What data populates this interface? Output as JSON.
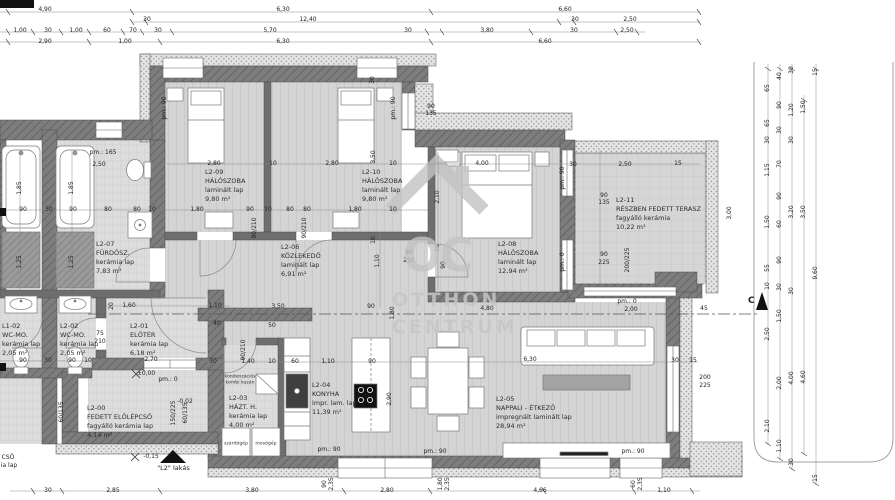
{
  "watermark": {
    "monogram": "OC",
    "line1": "OTTHON",
    "line2": "CENTRUM"
  },
  "unit_label": "\"L2\" lakás",
  "section_marker": "C",
  "colors": {
    "wall": "#7d7d7d",
    "insulation_dot": "#9f9f9f",
    "floor": "#d4d4d4",
    "watermark": "#c3c3c3",
    "fixture_dark": "#3f3f3f"
  },
  "rooms": [
    {
      "id": "L2-09",
      "name": "HÁLÓSZOBA",
      "floor": "laminált lap",
      "area": "9,80 m²"
    },
    {
      "id": "L2-10",
      "name": "HÁLÓSZOBA",
      "floor": "laminált lap",
      "area": "9,80 m²"
    },
    {
      "id": "L2-08",
      "name": "HÁLÓSZOBA",
      "floor": "laminált lap",
      "area": "12,94 m²"
    },
    {
      "id": "L2-11",
      "name": "RÉSZBEN FEDETT TERASZ",
      "floor": "fagyálló kerámia",
      "area": "10,22 m²"
    },
    {
      "id": "L2-06",
      "name": "KÖZLEKEDŐ",
      "floor": "laminált lap",
      "area": "6,91 m²"
    },
    {
      "id": "L2-07",
      "name": "FÜRDŐSZ.",
      "floor": "kerámia lap",
      "area": "7,83 m²"
    },
    {
      "id": "L1-02",
      "name": "WC-MO.",
      "floor": "kerámia lap",
      "area": "2,05 m²"
    },
    {
      "id": "L2-02",
      "name": "WC-MO.",
      "floor": "kerámia lap",
      "area": "2,05 m²"
    },
    {
      "id": "L2-01",
      "name": "ELŐTÉR",
      "floor": "kerámia lap",
      "area": "6,18 m²"
    },
    {
      "id": "L2-00",
      "name": "FEDETT ELŐLÉPCSŐ",
      "floor": "fagyálló kerámia lap",
      "area": "4,14 m²"
    },
    {
      "id": "L2-03",
      "name": "HÁZT. H.",
      "floor": "kerámia lap",
      "area": "4,00 m²"
    },
    {
      "id": "L2-04",
      "name": "KONYHA",
      "floor": "impr. lam. lap",
      "area": "11,39 m²"
    },
    {
      "id": "L2-05",
      "name": "NAPPALI - ÉTKEZŐ",
      "floor": "impregnált laminált lap",
      "area": "28,94 m²"
    }
  ],
  "fixtures": {
    "boiler_l1": "kondenzációs",
    "boiler_l2": "kombi kazán",
    "dryer": "szárítógép",
    "washer": "mosógép"
  },
  "dims": [
    {
      "t": "4,90",
      "x": 45,
      "y": 10
    },
    {
      "t": "6,30",
      "x": 283,
      "y": 10
    },
    {
      "t": "6,60",
      "x": 565,
      "y": 10
    },
    {
      "t": "30",
      "x": 147,
      "y": 20
    },
    {
      "t": "12,40",
      "x": 308,
      "y": 20
    },
    {
      "t": "30",
      "x": 575,
      "y": 20
    },
    {
      "t": "2,50",
      "x": 630,
      "y": 20
    },
    {
      "t": "1,00",
      "x": 20,
      "y": 31
    },
    {
      "t": "30",
      "x": 48,
      "y": 31
    },
    {
      "t": "1,00",
      "x": 76,
      "y": 31
    },
    {
      "t": "60",
      "x": 107,
      "y": 31
    },
    {
      "t": "70",
      "x": 133,
      "y": 31
    },
    {
      "t": "30",
      "x": 158,
      "y": 31
    },
    {
      "t": "5,70",
      "x": 270,
      "y": 31
    },
    {
      "t": "30",
      "x": 408,
      "y": 31
    },
    {
      "t": "3,80",
      "x": 487,
      "y": 31
    },
    {
      "t": "30",
      "x": 574,
      "y": 31
    },
    {
      "t": "2,50",
      "x": 627,
      "y": 31
    },
    {
      "t": "2,90",
      "x": 45,
      "y": 42
    },
    {
      "t": "1,00",
      "x": 125,
      "y": 42
    },
    {
      "t": "6,30",
      "x": 283,
      "y": 42
    },
    {
      "t": "6,60",
      "x": 545,
      "y": 42
    },
    {
      "t": "30",
      "x": 48,
      "y": 491
    },
    {
      "t": "2,85",
      "x": 113,
      "y": 491
    },
    {
      "t": "3,80",
      "x": 252,
      "y": 491
    },
    {
      "t": "2,80",
      "x": 387,
      "y": 491
    },
    {
      "t": "4,66",
      "x": 540,
      "y": 491
    },
    {
      "t": "1,10",
      "x": 664,
      "y": 491
    },
    {
      "t": "90",
      "x": 325,
      "y": 484,
      "r": 1
    },
    {
      "t": "2,35",
      "x": 332,
      "y": 484,
      "r": 1
    },
    {
      "t": "1,80",
      "x": 441,
      "y": 484,
      "r": 1
    },
    {
      "t": "2,35",
      "x": 448,
      "y": 484,
      "r": 1
    },
    {
      "t": "60",
      "x": 634,
      "y": 484,
      "r": 1
    },
    {
      "t": "2,35",
      "x": 641,
      "y": 484,
      "r": 1
    },
    {
      "t": "65",
      "x": 768,
      "y": 88,
      "r": 1
    },
    {
      "t": "65",
      "x": 768,
      "y": 123,
      "r": 1
    },
    {
      "t": "30",
      "x": 768,
      "y": 140,
      "r": 1
    },
    {
      "t": "1,15",
      "x": 768,
      "y": 170,
      "r": 1
    },
    {
      "t": "1,50",
      "x": 768,
      "y": 222,
      "r": 1
    },
    {
      "t": "55",
      "x": 768,
      "y": 268,
      "r": 1
    },
    {
      "t": "10",
      "x": 768,
      "y": 286,
      "r": 1
    },
    {
      "t": "2,50",
      "x": 768,
      "y": 334,
      "r": 1
    },
    {
      "t": "2,10",
      "x": 768,
      "y": 426,
      "r": 1
    },
    {
      "t": "40",
      "x": 780,
      "y": 76,
      "r": 1
    },
    {
      "t": "90",
      "x": 780,
      "y": 105,
      "r": 1
    },
    {
      "t": "30",
      "x": 780,
      "y": 130,
      "r": 1
    },
    {
      "t": "70",
      "x": 780,
      "y": 164,
      "r": 1
    },
    {
      "t": "90",
      "x": 780,
      "y": 196,
      "r": 1
    },
    {
      "t": "60",
      "x": 780,
      "y": 224,
      "r": 1
    },
    {
      "t": "90",
      "x": 780,
      "y": 260,
      "r": 1
    },
    {
      "t": "30",
      "x": 780,
      "y": 287,
      "r": 1
    },
    {
      "t": "1,50",
      "x": 780,
      "y": 316,
      "r": 1
    },
    {
      "t": "2,00",
      "x": 780,
      "y": 383,
      "r": 1
    },
    {
      "t": "1,10",
      "x": 780,
      "y": 446,
      "r": 1
    },
    {
      "t": "30",
      "x": 792,
      "y": 70,
      "r": 1
    },
    {
      "t": "1,20",
      "x": 792,
      "y": 110,
      "r": 1
    },
    {
      "t": "30",
      "x": 792,
      "y": 140,
      "r": 1
    },
    {
      "t": "3,20",
      "x": 792,
      "y": 212,
      "r": 1
    },
    {
      "t": "30",
      "x": 792,
      "y": 291,
      "r": 1
    },
    {
      "t": "4,00",
      "x": 792,
      "y": 378,
      "r": 1
    },
    {
      "t": "30",
      "x": 792,
      "y": 462,
      "r": 1
    },
    {
      "t": "1,50",
      "x": 804,
      "y": 107,
      "r": 1
    },
    {
      "t": "3,50",
      "x": 804,
      "y": 212,
      "r": 1
    },
    {
      "t": "4,60",
      "x": 804,
      "y": 377,
      "r": 1
    },
    {
      "t": "15",
      "x": 816,
      "y": 72,
      "r": 1
    },
    {
      "t": "9,60",
      "x": 816,
      "y": 273,
      "r": 1
    },
    {
      "t": "15",
      "x": 816,
      "y": 478,
      "r": 1
    },
    {
      "t": "90",
      "x": 23,
      "y": 210
    },
    {
      "t": "30",
      "x": 49,
      "y": 210
    },
    {
      "t": "90",
      "x": 73,
      "y": 210
    },
    {
      "t": "80",
      "x": 108,
      "y": 210
    },
    {
      "t": "80",
      "x": 137,
      "y": 210
    },
    {
      "t": "10",
      "x": 152,
      "y": 210
    },
    {
      "t": "1,80",
      "x": 197,
      "y": 210
    },
    {
      "t": "90",
      "x": 250,
      "y": 210
    },
    {
      "t": "10",
      "x": 268,
      "y": 210
    },
    {
      "t": "80",
      "x": 290,
      "y": 210
    },
    {
      "t": "80",
      "x": 307,
      "y": 210
    },
    {
      "t": "1,80",
      "x": 355,
      "y": 210
    },
    {
      "t": "10",
      "x": 393,
      "y": 210
    },
    {
      "t": "2,80",
      "x": 214,
      "y": 164
    },
    {
      "t": "10",
      "x": 273,
      "y": 164
    },
    {
      "t": "2,80",
      "x": 332,
      "y": 164
    },
    {
      "t": "10",
      "x": 393,
      "y": 164
    },
    {
      "t": "4,00",
      "x": 482,
      "y": 164
    },
    {
      "t": "30",
      "x": 573,
      "y": 165
    },
    {
      "t": "2,50",
      "x": 625,
      "y": 165
    },
    {
      "t": "15",
      "x": 678,
      "y": 164
    },
    {
      "t": "pm.: 165",
      "x": 103,
      "y": 153
    },
    {
      "t": "2,50",
      "x": 99,
      "y": 165
    },
    {
      "t": "90",
      "x": 604,
      "y": 196
    },
    {
      "t": "135",
      "x": 604,
      "y": 203
    },
    {
      "t": "90",
      "x": 604,
      "y": 255
    },
    {
      "t": "225",
      "x": 604,
      "y": 263
    },
    {
      "t": "90",
      "x": 409,
      "y": 253
    },
    {
      "t": "210",
      "x": 409,
      "y": 261
    },
    {
      "t": "90",
      "x": 431,
      "y": 107
    },
    {
      "t": "135",
      "x": 431,
      "y": 114
    },
    {
      "t": "50",
      "x": 272,
      "y": 326
    },
    {
      "t": "3,50",
      "x": 278,
      "y": 307
    },
    {
      "t": "90",
      "x": 371,
      "y": 307
    },
    {
      "t": "4,80",
      "x": 487,
      "y": 309
    },
    {
      "t": "2,00",
      "x": 631,
      "y": 310
    },
    {
      "t": "45",
      "x": 704,
      "y": 309
    },
    {
      "t": "pm.: 0",
      "x": 627,
      "y": 302
    },
    {
      "t": "30",
      "x": 213,
      "y": 362
    },
    {
      "t": "1,40",
      "x": 248,
      "y": 362
    },
    {
      "t": "10",
      "x": 272,
      "y": 362
    },
    {
      "t": "60",
      "x": 295,
      "y": 362
    },
    {
      "t": "1,10",
      "x": 328,
      "y": 362
    },
    {
      "t": "90",
      "x": 372,
      "y": 362
    },
    {
      "t": "6,30",
      "x": 530,
      "y": 360
    },
    {
      "t": "30",
      "x": 675,
      "y": 361
    },
    {
      "t": "15",
      "x": 693,
      "y": 361
    },
    {
      "t": "pm.: 90",
      "x": 329,
      "y": 450
    },
    {
      "t": "pm.: 90",
      "x": 435,
      "y": 452
    },
    {
      "t": "pm.: 90",
      "x": 633,
      "y": 452
    },
    {
      "t": "200",
      "x": 705,
      "y": 378
    },
    {
      "t": "225",
      "x": 705,
      "y": 386
    },
    {
      "t": "1,60",
      "x": 129,
      "y": 306
    },
    {
      "t": "1,10",
      "x": 215,
      "y": 306
    },
    {
      "t": "2,70",
      "x": 151,
      "y": 360
    },
    {
      "t": "75",
      "x": 100,
      "y": 334
    },
    {
      "t": "210",
      "x": 100,
      "y": 342
    },
    {
      "t": "90",
      "x": 23,
      "y": 361
    },
    {
      "t": "30",
      "x": 48,
      "y": 361
    },
    {
      "t": "90",
      "x": 72,
      "y": 361
    },
    {
      "t": "10",
      "x": 88,
      "y": 361
    },
    {
      "t": "40",
      "x": 217,
      "y": 324
    },
    {
      "t": "±0,00",
      "x": 146,
      "y": 374
    },
    {
      "t": "pm.: 0",
      "x": 168,
      "y": 380
    },
    {
      "t": "-0,02",
      "x": 185,
      "y": 402
    },
    {
      "t": "-0,15",
      "x": 151,
      "y": 457
    },
    {
      "t": "CSŐ",
      "x": 8,
      "y": 458
    },
    {
      "t": "ia lap",
      "x": 9,
      "y": 466
    },
    {
      "t": "1,85",
      "x": 20,
      "y": 188,
      "r": 1
    },
    {
      "t": "1,85",
      "x": 72,
      "y": 188,
      "r": 1
    },
    {
      "t": "1,25",
      "x": 20,
      "y": 262,
      "r": 1
    },
    {
      "t": "1,25",
      "x": 72,
      "y": 262,
      "r": 1
    },
    {
      "t": "3,50",
      "x": 374,
      "y": 157,
      "r": 1
    },
    {
      "t": "2,10",
      "x": 438,
      "y": 197,
      "r": 1
    },
    {
      "t": "10",
      "x": 438,
      "y": 248,
      "r": 1
    },
    {
      "t": "90",
      "x": 444,
      "y": 265,
      "r": 1
    },
    {
      "t": "pm.: 90",
      "x": 563,
      "y": 178,
      "r": 1
    },
    {
      "t": "pm.: 0",
      "x": 563,
      "y": 262,
      "r": 1
    },
    {
      "t": "pm.: 90",
      "x": 165,
      "y": 108,
      "r": 1
    },
    {
      "t": "pm.: 90",
      "x": 394,
      "y": 108,
      "r": 1
    },
    {
      "t": "30",
      "x": 373,
      "y": 80,
      "r": 1
    },
    {
      "t": "3,00",
      "x": 730,
      "y": 213,
      "r": 1
    },
    {
      "t": "200/225",
      "x": 628,
      "y": 260,
      "r": 1
    },
    {
      "t": "10",
      "x": 374,
      "y": 240,
      "r": 1
    },
    {
      "t": "1,10",
      "x": 378,
      "y": 261,
      "r": 1
    },
    {
      "t": "90/210",
      "x": 255,
      "y": 228,
      "r": 1
    },
    {
      "t": "90/210",
      "x": 305,
      "y": 228,
      "r": 1
    },
    {
      "t": "90/210",
      "x": 244,
      "y": 350,
      "r": 1
    },
    {
      "t": "2,90",
      "x": 390,
      "y": 399,
      "r": 1
    },
    {
      "t": "20",
      "x": 112,
      "y": 306,
      "r": 1
    },
    {
      "t": "150/225",
      "x": 174,
      "y": 413,
      "r": 1
    },
    {
      "t": "60/135",
      "x": 186,
      "y": 413,
      "r": 1
    },
    {
      "t": "60/135",
      "x": 62,
      "y": 412,
      "r": 1
    },
    {
      "t": "1,80",
      "x": 393,
      "y": 313,
      "r": 1
    }
  ]
}
